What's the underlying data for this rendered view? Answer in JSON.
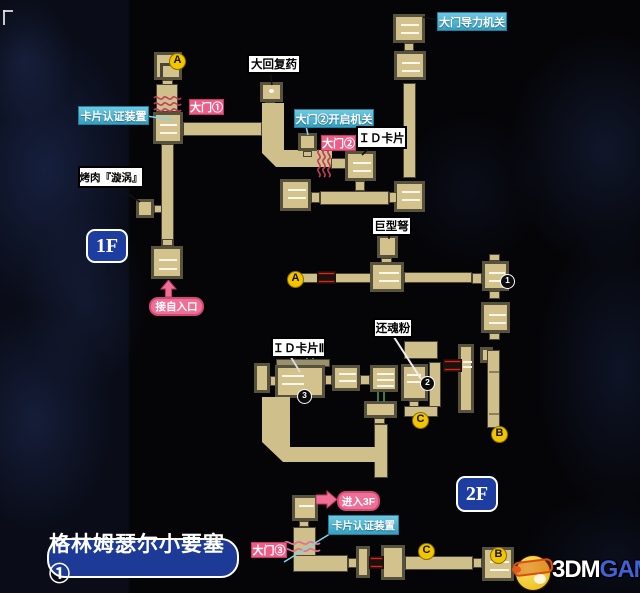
{
  "map_title": "格林姆瑟尔小要塞①",
  "floors": {
    "f1": "1F",
    "f2": "2F"
  },
  "labels": {
    "gate_power": {
      "text": "大门导力机关",
      "style": "cyan"
    },
    "big_heal": {
      "text": "大回复药",
      "style": "white"
    },
    "card_auth_1f": {
      "text": "卡片认证装置",
      "style": "cyan"
    },
    "gate1": {
      "text": "大门①",
      "style": "pink"
    },
    "gate2_opener": {
      "text": "大门②开启机关",
      "style": "cyan"
    },
    "gate2": {
      "text": "大门②",
      "style": "pink"
    },
    "id_card": {
      "text": "ＩＤ卡片",
      "style": "white"
    },
    "bbq": {
      "text": "烤肉『漩涡』",
      "style": "white"
    },
    "from_entrance": {
      "text": "接自入口",
      "style": "pink-pill"
    },
    "giant_bow": {
      "text": "巨型弩",
      "style": "white"
    },
    "revival_powder": {
      "text": "还魂粉",
      "style": "white"
    },
    "id_card2": {
      "text": "ＩＤ卡片Ⅱ",
      "style": "white"
    },
    "enter_3f": {
      "text": "进入3F",
      "style": "pink-pill"
    },
    "card_auth_2f": {
      "text": "卡片认证装置",
      "style": "cyan"
    },
    "gate3": {
      "text": "大门③",
      "style": "pink"
    }
  },
  "markers": {
    "a1": "A",
    "a2": "A",
    "b1": "B",
    "b2": "B",
    "c1": "C",
    "c2": "C",
    "n1": "1",
    "n2": "2",
    "n3": "3"
  },
  "watermark": {
    "white": "3DM",
    "blue": "GAME"
  },
  "colors": {
    "corridor_tan": "#d3c28c",
    "room_border": "#57523e",
    "cyan_label": "#45b3d4",
    "pink_label": "#ee5c88",
    "pill_pink": "#ef6f97",
    "badge_blue": "#1d3da0",
    "marker_yellow": "#f2c500",
    "marker_black": "#0c0c0c",
    "door_red": "#d42a1e",
    "squiggle_red": "#c23b5a",
    "squiggle_pink": "#df7296",
    "watermark_blue": "#3f62d6",
    "background": "#050508"
  }
}
